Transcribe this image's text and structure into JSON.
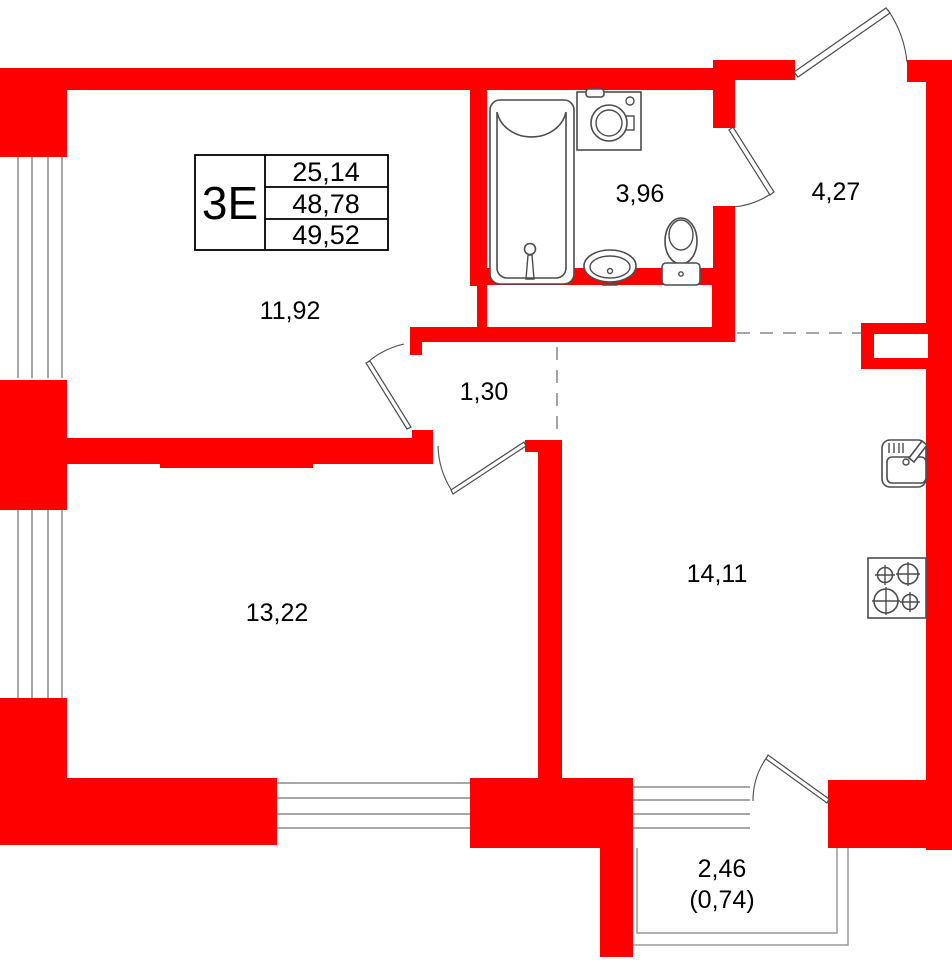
{
  "plan": {
    "title": "apartment-floor-plan",
    "unit_table": {
      "type_label": "3Е",
      "values": [
        "25,14",
        "48,78",
        "49,52"
      ]
    },
    "rooms": [
      {
        "id": "room-upper",
        "area": "11,92"
      },
      {
        "id": "bathroom",
        "area": "3,96"
      },
      {
        "id": "hallway",
        "area": "4,27"
      },
      {
        "id": "corridor",
        "area": "1,30"
      },
      {
        "id": "room-lower",
        "area": "13,22"
      },
      {
        "id": "kitchen-living",
        "area": "14,11"
      },
      {
        "id": "balcony",
        "area": "2,46",
        "area_secondary": "(0,74)"
      }
    ],
    "icons": [
      "bathtub-icon",
      "washing-machine-icon",
      "wash-basin-icon",
      "toilet-icon",
      "kitchen-sink-icon",
      "stove-icon"
    ],
    "colors": {
      "wall": "#ff0000",
      "line": "#4d4d4d",
      "window": "#8c8c8c",
      "dash": "#9a9a9a",
      "text": "#000000"
    }
  }
}
